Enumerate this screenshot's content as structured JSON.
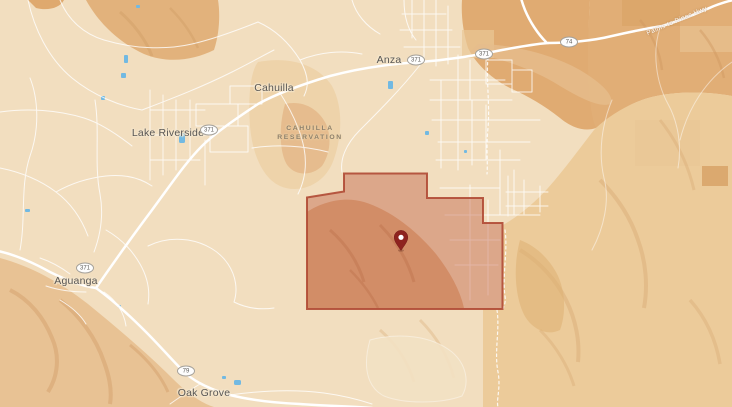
{
  "map": {
    "place_labels": {
      "anza": "Anza",
      "cahuilla": "Cahuilla",
      "lake_riverside": "Lake Riverside",
      "aguanga": "Aguanga",
      "oak_grove": "Oak Grove"
    },
    "area_label": {
      "line1": "CAHUILLA",
      "line2": "RESERVATION"
    },
    "road_label": {
      "palms_to_pines": "Palms to Pines Hwy"
    },
    "route_shields": [
      {
        "route": "371"
      },
      {
        "route": "371"
      },
      {
        "route": "74"
      },
      {
        "route": "371"
      },
      {
        "route": "371"
      },
      {
        "route": "79"
      }
    ],
    "marker": {
      "kind": "location-pin",
      "color": "#8e231f"
    },
    "parcel_overlay": {
      "fill": "#bf5a40",
      "fill_opacity": "0.42",
      "stroke": "#b04a34"
    },
    "colors": {
      "base": "#f2debf",
      "terrain_light": "#eccb9a",
      "terrain_orange": "#e0ab73",
      "terrain_dark_orange": "#d9a263",
      "road": "#ffffff",
      "water": "#72b9e2",
      "place_text": "#595755",
      "area_text": "#8d7f6b"
    }
  }
}
